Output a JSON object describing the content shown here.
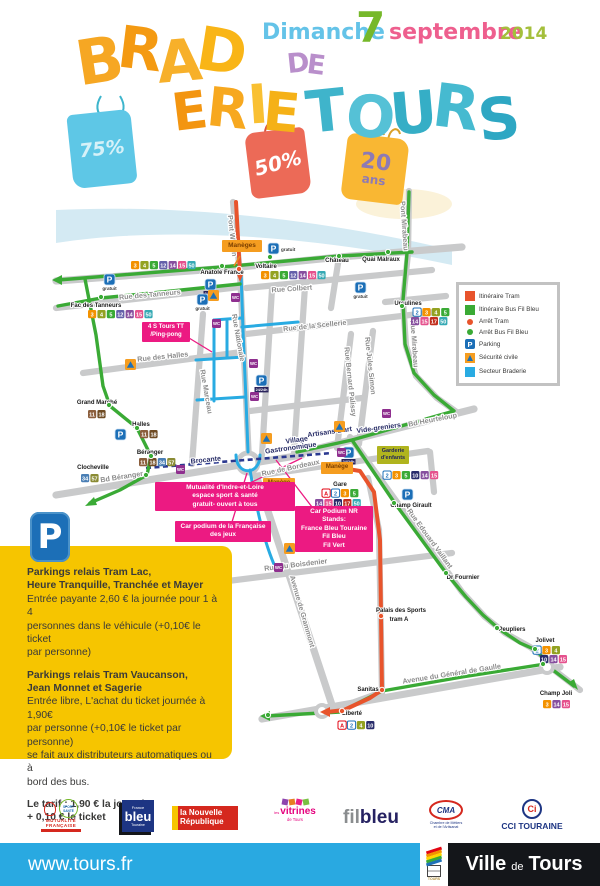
{
  "event": {
    "date": {
      "day": "Dimanche",
      "num": "7",
      "month": "septembre",
      "year": "2014"
    },
    "title_letters": [
      {
        "c": "B",
        "x": 76,
        "y": 30,
        "s": 62,
        "r": -9,
        "col": "#f6a723"
      },
      {
        "c": "R",
        "x": 118,
        "y": 20,
        "s": 58,
        "r": 7,
        "col": "#f49a12"
      },
      {
        "c": "A",
        "x": 157,
        "y": 32,
        "s": 58,
        "r": -5,
        "col": "#f7b02a"
      },
      {
        "c": "D",
        "x": 197,
        "y": 22,
        "s": 60,
        "r": 9,
        "col": "#f9b517"
      },
      {
        "c": "E",
        "x": 172,
        "y": 86,
        "s": 52,
        "r": -7,
        "col": "#f39510"
      },
      {
        "c": "R",
        "x": 207,
        "y": 82,
        "s": 54,
        "r": 6,
        "col": "#f7a81f"
      },
      {
        "c": "I",
        "x": 248,
        "y": 78,
        "s": 54,
        "r": -4,
        "col": "#f9c032"
      },
      {
        "c": "E",
        "x": 263,
        "y": 86,
        "s": 54,
        "r": 5,
        "col": "#f5b117"
      },
      {
        "c": "D",
        "x": 287,
        "y": 50,
        "s": 27,
        "r": -6,
        "col": "#b98fcb"
      },
      {
        "c": "E",
        "x": 307,
        "y": 52,
        "s": 27,
        "r": 7,
        "col": "#b98fcb"
      },
      {
        "c": "T",
        "x": 306,
        "y": 82,
        "s": 58,
        "r": -6,
        "col": "#3fb4cb"
      },
      {
        "c": "O",
        "x": 346,
        "y": 88,
        "s": 58,
        "r": 5,
        "col": "#55c1d6"
      },
      {
        "c": "U",
        "x": 390,
        "y": 84,
        "s": 58,
        "r": -5,
        "col": "#35aec6"
      },
      {
        "c": "R",
        "x": 433,
        "y": 78,
        "s": 60,
        "r": 7,
        "col": "#46bad0"
      },
      {
        "c": "S",
        "x": 478,
        "y": 90,
        "s": 58,
        "r": -6,
        "col": "#2ea7c3"
      }
    ],
    "bags": [
      {
        "label": "75%"
      },
      {
        "label": "50%"
      },
      {
        "label": "20",
        "label2": "ans"
      }
    ]
  },
  "legend": {
    "items": [
      {
        "label": "Itinéraire Tram"
      },
      {
        "label": "Itinéraire Bus Fil Bleu"
      },
      {
        "label": "Arrêt Tram"
      },
      {
        "label": "Arrêt Bus Fil Bleu"
      },
      {
        "label": "Parking"
      },
      {
        "label": "Sécurité civile"
      },
      {
        "label": "Secteur Braderie"
      }
    ]
  },
  "parking_info": {
    "icon_letter": "P",
    "s1_title": "Parkings relais Tram Lac,\nHeure Tranquille, Tranchée et Mayer",
    "s1_body": "Entrée payante 2,60 € la journée pour 1 à 4\npersonnes dans le véhicule (+0,10€ le ticket\npar personne)",
    "s2_title": "Parkings relais Tram Vaucanson,\nJean Monnet et Sagerie",
    "s2_body": "Entrée libre, L'achat du ticket journée à 1,90€\npar personne (+0,10€ le ticket par personne)\nse fait aux distributeurs automatiques ou à\nbord des bus.",
    "tariff": "Le tarif : 1,90 € la journée\n+ 0,10 € le ticket"
  },
  "map": {
    "p_letter": "P",
    "wc_letter": "WC",
    "outline": [
      "A",
      "2"
    ],
    "line_colors": {
      "A": "#e30613",
      "2": "#1d71b8",
      "3": "#f39200",
      "4": "#93a222",
      "5": "#3aaa35",
      "10": "#292c6b",
      "11": "#8b5e3c",
      "12": "#6460aa",
      "14": "#864f9e",
      "15": "#e5518d",
      "17": "#c22f1e",
      "18": "#6f4b23",
      "34": "#4a7fb5",
      "50": "#36a9b4",
      "57": "#8a8b34"
    },
    "street_labels": [
      {
        "t": "Pont Wilson",
        "x": 230,
        "y": 236,
        "r": 84
      },
      {
        "t": "Pont Mirabeau",
        "x": 402,
        "y": 226,
        "r": 86
      },
      {
        "t": "Rue des Tanneurs",
        "x": 150,
        "y": 297,
        "r": -5
      },
      {
        "t": "Rue Colbert",
        "x": 292,
        "y": 291,
        "r": -4
      },
      {
        "t": "Rue de la Scellerie",
        "x": 315,
        "y": 328,
        "r": -6
      },
      {
        "t": "Rue Nationale",
        "x": 236,
        "y": 338,
        "r": 80
      },
      {
        "t": "Rue Marceau",
        "x": 204,
        "y": 392,
        "r": 80
      },
      {
        "t": "Rue des Halles",
        "x": 163,
        "y": 359,
        "r": -6
      },
      {
        "t": "Rue Bernard Palissy",
        "x": 348,
        "y": 382,
        "r": 84
      },
      {
        "t": "Rue Jules Simon",
        "x": 368,
        "y": 366,
        "r": 84
      },
      {
        "t": "Rue Mirabeau",
        "x": 412,
        "y": 344,
        "r": 86
      },
      {
        "t": "Bd Heurteloup",
        "x": 433,
        "y": 422,
        "r": -11
      },
      {
        "t": "Bd Béranger",
        "x": 122,
        "y": 479,
        "r": -9
      },
      {
        "t": "Rue de Bordeaux",
        "x": 291,
        "y": 470,
        "r": -12
      },
      {
        "t": "Rue du Boisdenier",
        "x": 296,
        "y": 567,
        "r": -7
      },
      {
        "t": "Avenue de Grammont",
        "x": 300,
        "y": 612,
        "r": 74
      },
      {
        "t": "Avenue du Général de Gaulle",
        "x": 452,
        "y": 676,
        "r": -9
      },
      {
        "t": "Rue Edouard Vaillant",
        "x": 428,
        "y": 540,
        "r": 54
      },
      {
        "t": "Brocante",
        "x": 206,
        "y": 462,
        "r": -6,
        "n": 1
      },
      {
        "t": "Artisans d'art",
        "x": 330,
        "y": 434,
        "r": -8,
        "n": 1
      },
      {
        "t": "Vide-greniers",
        "x": 379,
        "y": 430,
        "r": -8,
        "n": 1
      },
      {
        "t": "Village",
        "x": 297,
        "y": 442,
        "r": -8,
        "n": 1
      },
      {
        "t": "Gastronomique",
        "x": 291,
        "y": 450,
        "r": -8,
        "n": 1
      }
    ],
    "stop_labels": [
      {
        "t": "Anatole France",
        "x": 222,
        "y": 274
      },
      {
        "t": "Voltaire",
        "x": 266,
        "y": 268
      },
      {
        "t": "Château",
        "x": 337,
        "y": 262
      },
      {
        "t": "Quai Malraux",
        "x": 381,
        "y": 261
      },
      {
        "t": "Ursulines",
        "x": 408,
        "y": 305
      },
      {
        "t": "Fac des Tanneurs",
        "x": 96,
        "y": 307
      },
      {
        "t": "Grand Marché",
        "x": 97,
        "y": 404
      },
      {
        "t": "Halles",
        "x": 141,
        "y": 426
      },
      {
        "t": "Béranger",
        "x": 150,
        "y": 454
      },
      {
        "t": "Clocheville",
        "x": 93,
        "y": 469
      },
      {
        "t": "Gare",
        "x": 340,
        "y": 486
      },
      {
        "t": "Champ Girault",
        "x": 411,
        "y": 507
      },
      {
        "t": "Dr Fournier",
        "x": 463,
        "y": 579
      },
      {
        "t": "Palais des Sports",
        "x": 401,
        "y": 612
      },
      {
        "t": "tram A",
        "x": 399,
        "y": 621
      },
      {
        "t": "Sanitas",
        "x": 368,
        "y": 691
      },
      {
        "t": "Liberté",
        "x": 352,
        "y": 715
      },
      {
        "t": "Peupliers",
        "x": 512,
        "y": 631
      },
      {
        "t": "Jolivet",
        "x": 545,
        "y": 642
      },
      {
        "t": "Champ Joli",
        "x": 556,
        "y": 695
      }
    ],
    "badge_rows": [
      {
        "x": 131,
        "y": 261,
        "l": [
          "3",
          "4",
          "5",
          "12",
          "14",
          "15",
          "50"
        ]
      },
      {
        "x": 261,
        "y": 271,
        "l": [
          "3",
          "4",
          "5",
          "12",
          "14",
          "15",
          "50"
        ]
      },
      {
        "x": 88,
        "y": 310,
        "l": [
          "3",
          "4",
          "5",
          "12",
          "14",
          "15",
          "50"
        ]
      },
      {
        "x": 413,
        "y": 308,
        "l": [
          "2",
          "3",
          "4",
          "5"
        ]
      },
      {
        "x": 411,
        "y": 317,
        "l": [
          "14",
          "15",
          "17",
          "50"
        ]
      },
      {
        "x": 88,
        "y": 410,
        "l": [
          "11",
          "18"
        ]
      },
      {
        "x": 140,
        "y": 430,
        "l": [
          "11",
          "18"
        ]
      },
      {
        "x": 139,
        "y": 458,
        "l": [
          "11",
          "18",
          "34",
          "57"
        ]
      },
      {
        "x": 81,
        "y": 474,
        "l": [
          "34",
          "57"
        ]
      },
      {
        "x": 322,
        "y": 489,
        "l": [
          "A",
          "2",
          "3",
          "5"
        ]
      },
      {
        "x": 315,
        "y": 499,
        "l": [
          "14",
          "15",
          "10",
          "17",
          "50"
        ]
      },
      {
        "x": 383,
        "y": 471,
        "l": [
          "2",
          "3",
          "5",
          "10",
          "14",
          "15"
        ]
      },
      {
        "x": 533,
        "y": 646,
        "l": [
          "2",
          "3",
          "4"
        ]
      },
      {
        "x": 540,
        "y": 655,
        "l": [
          "10",
          "14",
          "15"
        ]
      },
      {
        "x": 543,
        "y": 700,
        "l": [
          "3",
          "14",
          "15"
        ]
      },
      {
        "x": 338,
        "y": 721,
        "l": [
          "A",
          "2",
          "4",
          "10"
        ]
      }
    ],
    "parkings": [
      {
        "x": 104,
        "y": 274,
        "c": "gratuit"
      },
      {
        "x": 205,
        "y": 279,
        "c": "24/24h"
      },
      {
        "x": 197,
        "y": 294,
        "c": "gratuit"
      },
      {
        "x": 268,
        "y": 243,
        "c": "gratuit",
        "s": "r"
      },
      {
        "x": 355,
        "y": 282,
        "c": "gratuit"
      },
      {
        "x": 115,
        "y": 429,
        "c": ""
      },
      {
        "x": 256,
        "y": 375,
        "c": "24/24h"
      },
      {
        "x": 343,
        "y": 447,
        "c": "24/24h"
      },
      {
        "x": 402,
        "y": 489,
        "c": ""
      }
    ],
    "wcs": [
      [
        231,
        293
      ],
      [
        212,
        319
      ],
      [
        249,
        359
      ],
      [
        250,
        392
      ],
      [
        176,
        465
      ],
      [
        337,
        448
      ],
      [
        382,
        409
      ],
      [
        274,
        563
      ],
      [
        275,
        494
      ]
    ],
    "securite": [
      [
        208,
        290
      ],
      [
        125,
        359
      ],
      [
        261,
        433
      ],
      [
        334,
        421
      ],
      [
        284,
        543
      ]
    ],
    "tram_stops": [
      [
        239,
        269
      ],
      [
        381,
        616
      ],
      [
        382,
        690
      ],
      [
        342,
        711
      ]
    ],
    "bus_stops": [
      [
        222,
        266
      ],
      [
        270,
        257
      ],
      [
        339,
        256
      ],
      [
        388,
        252
      ],
      [
        402,
        306
      ],
      [
        101,
        297
      ],
      [
        109,
        405
      ],
      [
        137,
        428
      ],
      [
        151,
        456
      ],
      [
        146,
        475
      ],
      [
        394,
        503
      ],
      [
        446,
        573
      ],
      [
        497,
        628
      ],
      [
        535,
        649
      ],
      [
        268,
        715
      ],
      [
        543,
        664
      ]
    ],
    "event_boxes": [
      {
        "name": "maneges-box",
        "x": 222,
        "y": 240,
        "w": 40,
        "bg": "#f59d20",
        "fg": "#7b3f00",
        "lines": [
          "Manèges"
        ],
        "fs": 6.5
      },
      {
        "name": "manege-box-grammont",
        "x": 263,
        "y": 478,
        "w": 32,
        "bg": "#f59d20",
        "fg": "#7b3f00",
        "lines": [
          "Manège"
        ],
        "fs": 6
      },
      {
        "name": "manege-box-gare",
        "x": 321,
        "y": 462,
        "w": 32,
        "bg": "#f59d20",
        "fg": "#7b3f00",
        "lines": [
          "Manège"
        ],
        "fs": 6
      },
      {
        "name": "garderie-box",
        "x": 377,
        "y": 446,
        "w": 32,
        "bg": "#b0b41e",
        "fg": "#23285a",
        "lines": [
          "Garderie",
          "d'enfants"
        ],
        "fs": 5.5
      },
      {
        "name": "pingpong-box",
        "x": 142,
        "y": 322,
        "w": 48,
        "bg": "#ec1a82",
        "fg": "#ffffff",
        "lines": [
          "4 S Tours TT",
          "/Ping-pong"
        ],
        "fs": 6
      },
      {
        "name": "mutualite-box",
        "x": 155,
        "y": 482,
        "w": 140,
        "bg": "#ec1a82",
        "fg": "#ffffff",
        "lines": [
          "Mutualité d'Indre-et-Loire",
          "espace sport & santé",
          "gratuit- ouvert à tous"
        ],
        "fs": 6.5
      },
      {
        "name": "fdj-box",
        "x": 175,
        "y": 521,
        "w": 96,
        "bg": "#ec1a82",
        "fg": "#ffffff",
        "lines": [
          "Car podium de la Française",
          "des jeux"
        ],
        "fs": 6.5
      },
      {
        "name": "nr-box",
        "x": 295,
        "y": 506,
        "w": 78,
        "bg": "#ec1a82",
        "fg": "#ffffff",
        "lines": [
          "Car Podium NR",
          "Stands:",
          "France Bleu Touraine",
          "Fil Bleu",
          "Fil Vert"
        ],
        "fs": 6.5
      }
    ]
  },
  "footer": {
    "url": "www.tours.fr",
    "logos": {
      "mutualite_line1": "MUTUALITÉ",
      "mutualite_line2": "FRANÇAISE",
      "mutualite_badge": "SPORT SANTÉ",
      "fb_top": "France",
      "fb_main": "bleu",
      "fb_sub": "Touraine",
      "nr_line1": "la Nouvelle",
      "nr_line2": "République",
      "vit_pre": "les",
      "vit_main": "vitrines",
      "vit_sub": "de Tours",
      "fil_1": "fil",
      "fil_2": "bleu",
      "cma_main": "CMA",
      "cma_sub": "Chambre de Métiers\net de l'Artisanat",
      "cci_icon": "Ci",
      "cci_label": "CCI TOURAINE",
      "tours_mini": "TOURS"
    },
    "city": {
      "ville": "Ville",
      "de": "de",
      "tours": "Tours"
    }
  }
}
